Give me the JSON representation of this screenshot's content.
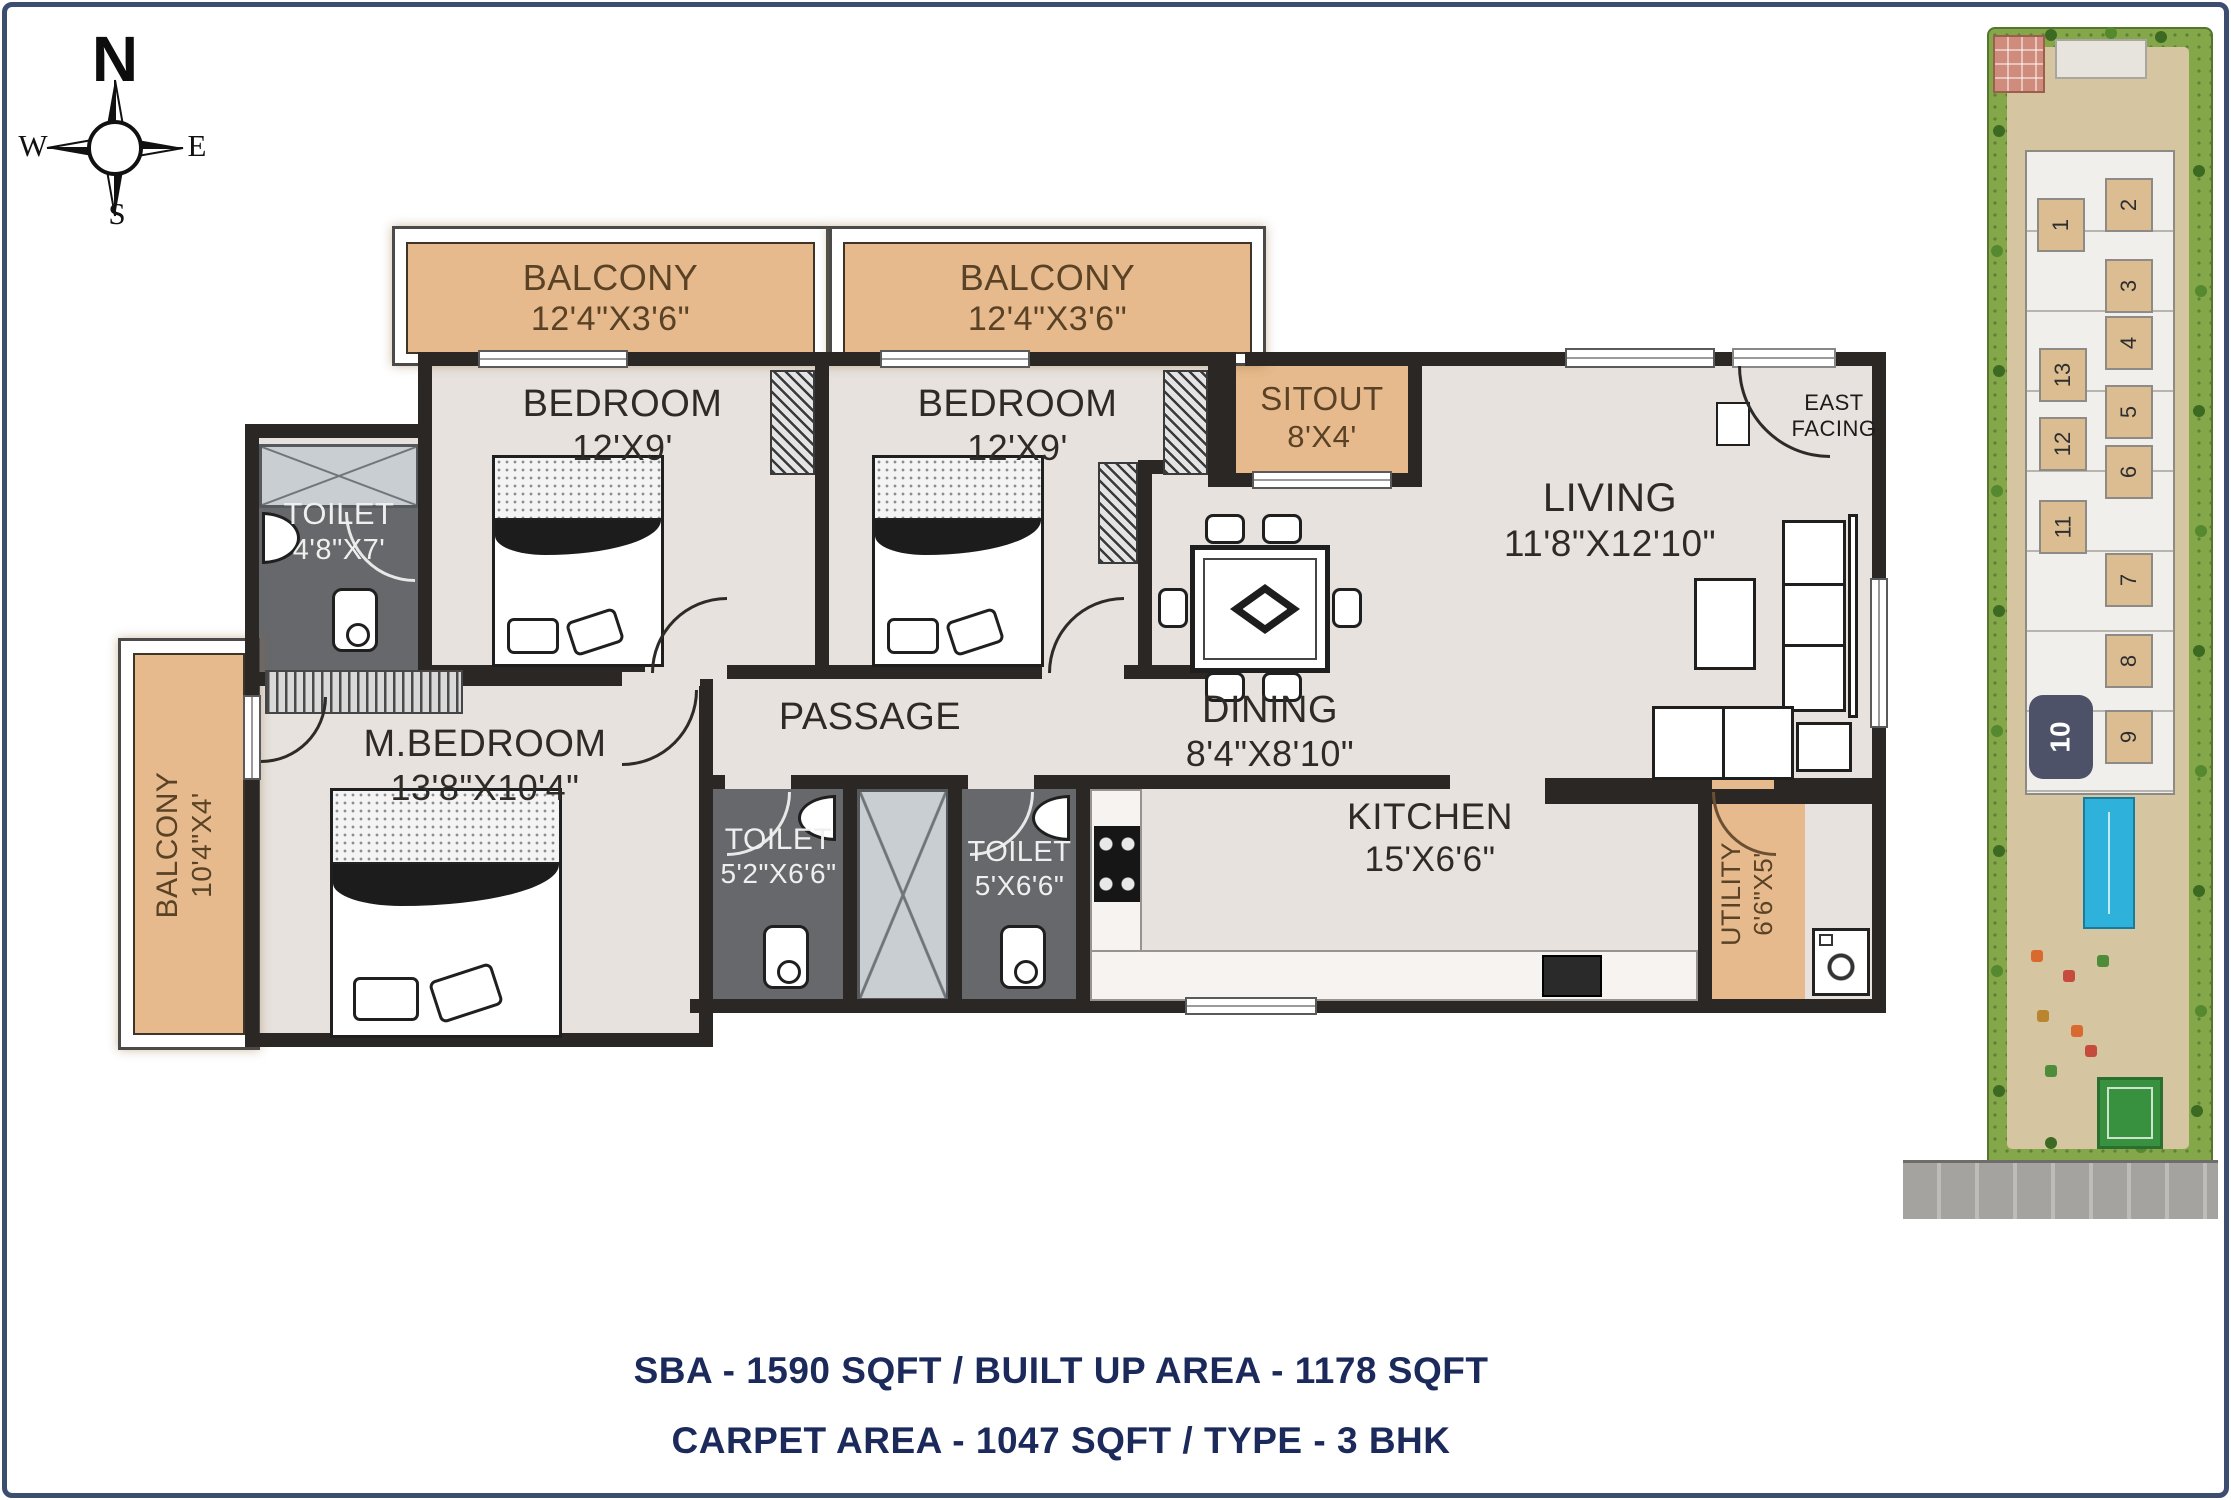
{
  "compass": {
    "north": "N",
    "east": "E",
    "south": "S",
    "west": "W"
  },
  "rooms": {
    "balcony_top_1": {
      "label": "BALCONY",
      "dims": "12'4\"X3'6\""
    },
    "balcony_top_2": {
      "label": "BALCONY",
      "dims": "12'4\"X3'6\""
    },
    "bedroom_1": {
      "label": "BEDROOM",
      "dims": "12'X9'"
    },
    "bedroom_2": {
      "label": "BEDROOM",
      "dims": "12'X9'"
    },
    "toilet_1": {
      "label": "TOILET",
      "dims": "4'8\"X7'"
    },
    "sitout": {
      "label": "SITOUT",
      "dims": "8'X4'"
    },
    "living": {
      "label": "LIVING",
      "dims": "11'8\"X12'10\""
    },
    "m_bedroom": {
      "label": "M.BEDROOM",
      "dims": "13'8\"X10'4\""
    },
    "balcony_left": {
      "label": "BALCONY",
      "dims": "10'4\"X4'"
    },
    "passage": {
      "label": "PASSAGE"
    },
    "dining": {
      "label": "DINING",
      "dims": "8'4\"X8'10\""
    },
    "toilet_2": {
      "label": "TOILET",
      "dims": "5'2\"X6'6\""
    },
    "toilet_3": {
      "label": "TOILET",
      "dims": "5'X6'6\""
    },
    "kitchen": {
      "label": "KITCHEN",
      "dims": "15'X6'6\""
    },
    "utility": {
      "label": "UTILITY",
      "dims": "6'6\"X5'"
    }
  },
  "entrance": {
    "label": "EAST FACING"
  },
  "site_plan": {
    "units_left": [
      "1",
      "13",
      "12",
      "11"
    ],
    "units_right": [
      "2",
      "3",
      "4",
      "5",
      "6",
      "7",
      "8",
      "9"
    ],
    "highlighted_unit": "10"
  },
  "footer": {
    "line1": "SBA - 1590 SQFT / BUILT UP AREA - 1178 SQFT",
    "line2": "CARPET AREA - 1047 SQFT / TYPE - 3 BHK"
  },
  "colors": {
    "accent_navy": "#1b2a5b",
    "balcony_tan": "#e6ba8c",
    "toilet_gray": "#67686b",
    "highlight_unit": "#4d5268"
  }
}
